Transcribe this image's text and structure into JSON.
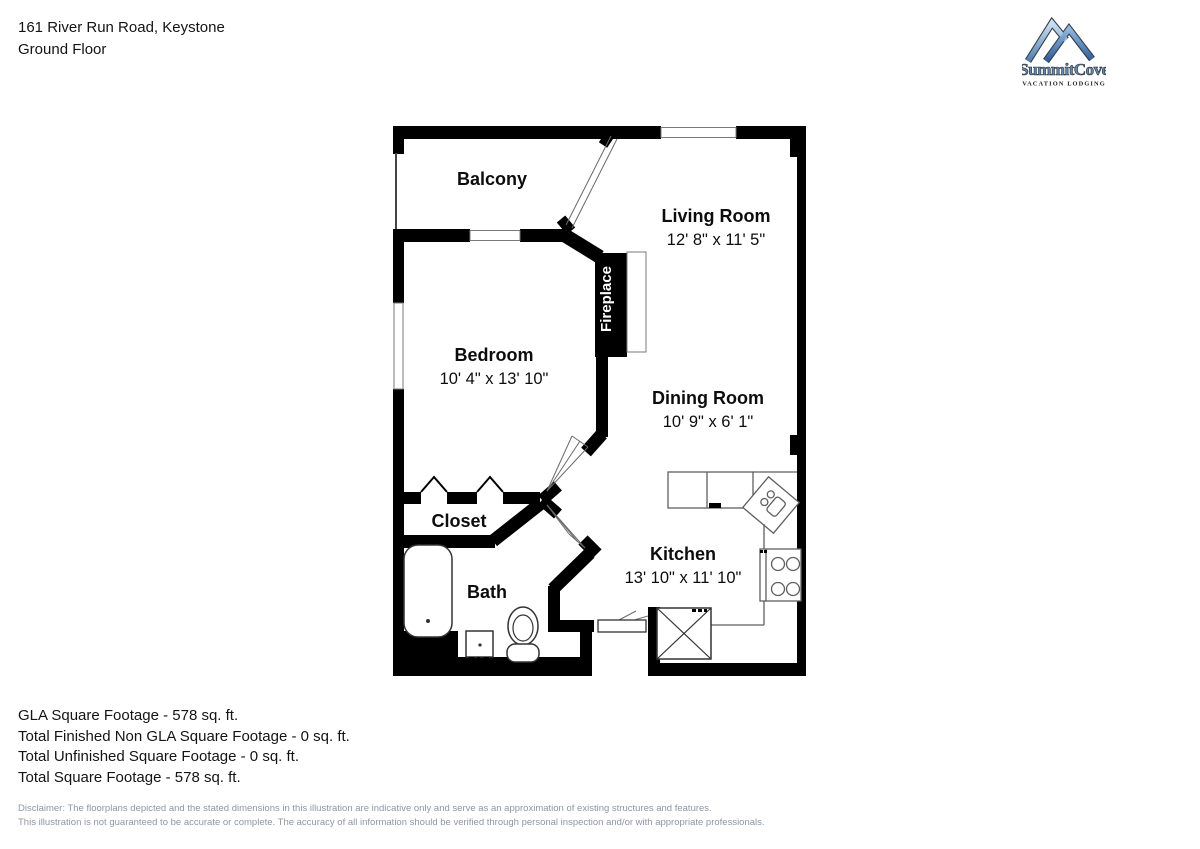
{
  "header": {
    "address_line": "161 River Run Road, Keystone",
    "floor_line": "Ground Floor"
  },
  "logo": {
    "brand": "SummitCove",
    "tagline": "VACATION LODGING"
  },
  "plan": {
    "rooms": {
      "balcony": {
        "label": "Balcony"
      },
      "living": {
        "label": "Living Room",
        "dims": "12' 8\" x 11' 5\""
      },
      "bedroom": {
        "label": "Bedroom",
        "dims": "10' 4\" x 13' 10\""
      },
      "dining": {
        "label": "Dining Room",
        "dims": "10' 9\" x 6' 1\""
      },
      "closet": {
        "label": "Closet"
      },
      "kitchen": {
        "label": "Kitchen",
        "dims": "13' 10\" x 11' 10\""
      },
      "bath": {
        "label": "Bath"
      },
      "fireplace": {
        "label": "Fireplace"
      }
    }
  },
  "footer": {
    "lines": [
      "GLA Square Footage - 578 sq. ft.",
      "Total Finished Non GLA Square Footage - 0 sq. ft.",
      "Total Unfinished Square Footage - 0 sq. ft.",
      "Total Square Footage - 578 sq. ft."
    ]
  },
  "disclaimer": {
    "lines": [
      "Disclaimer: The floorplans depicted and the stated dimensions in this illustration are indicative only and serve as an approximation of existing structures and features.",
      "This illustration is not guaranteed to be accurate or complete. The accuracy of all information should be verified through personal inspection and/or with appropriate professionals."
    ]
  },
  "colors": {
    "wall": "#000000",
    "fixture_line": "#5f5f5f",
    "disclaimer_text": "#8d96a8",
    "logo_blue_light": "#a8cdec",
    "logo_blue_dark": "#2c5e9e"
  }
}
